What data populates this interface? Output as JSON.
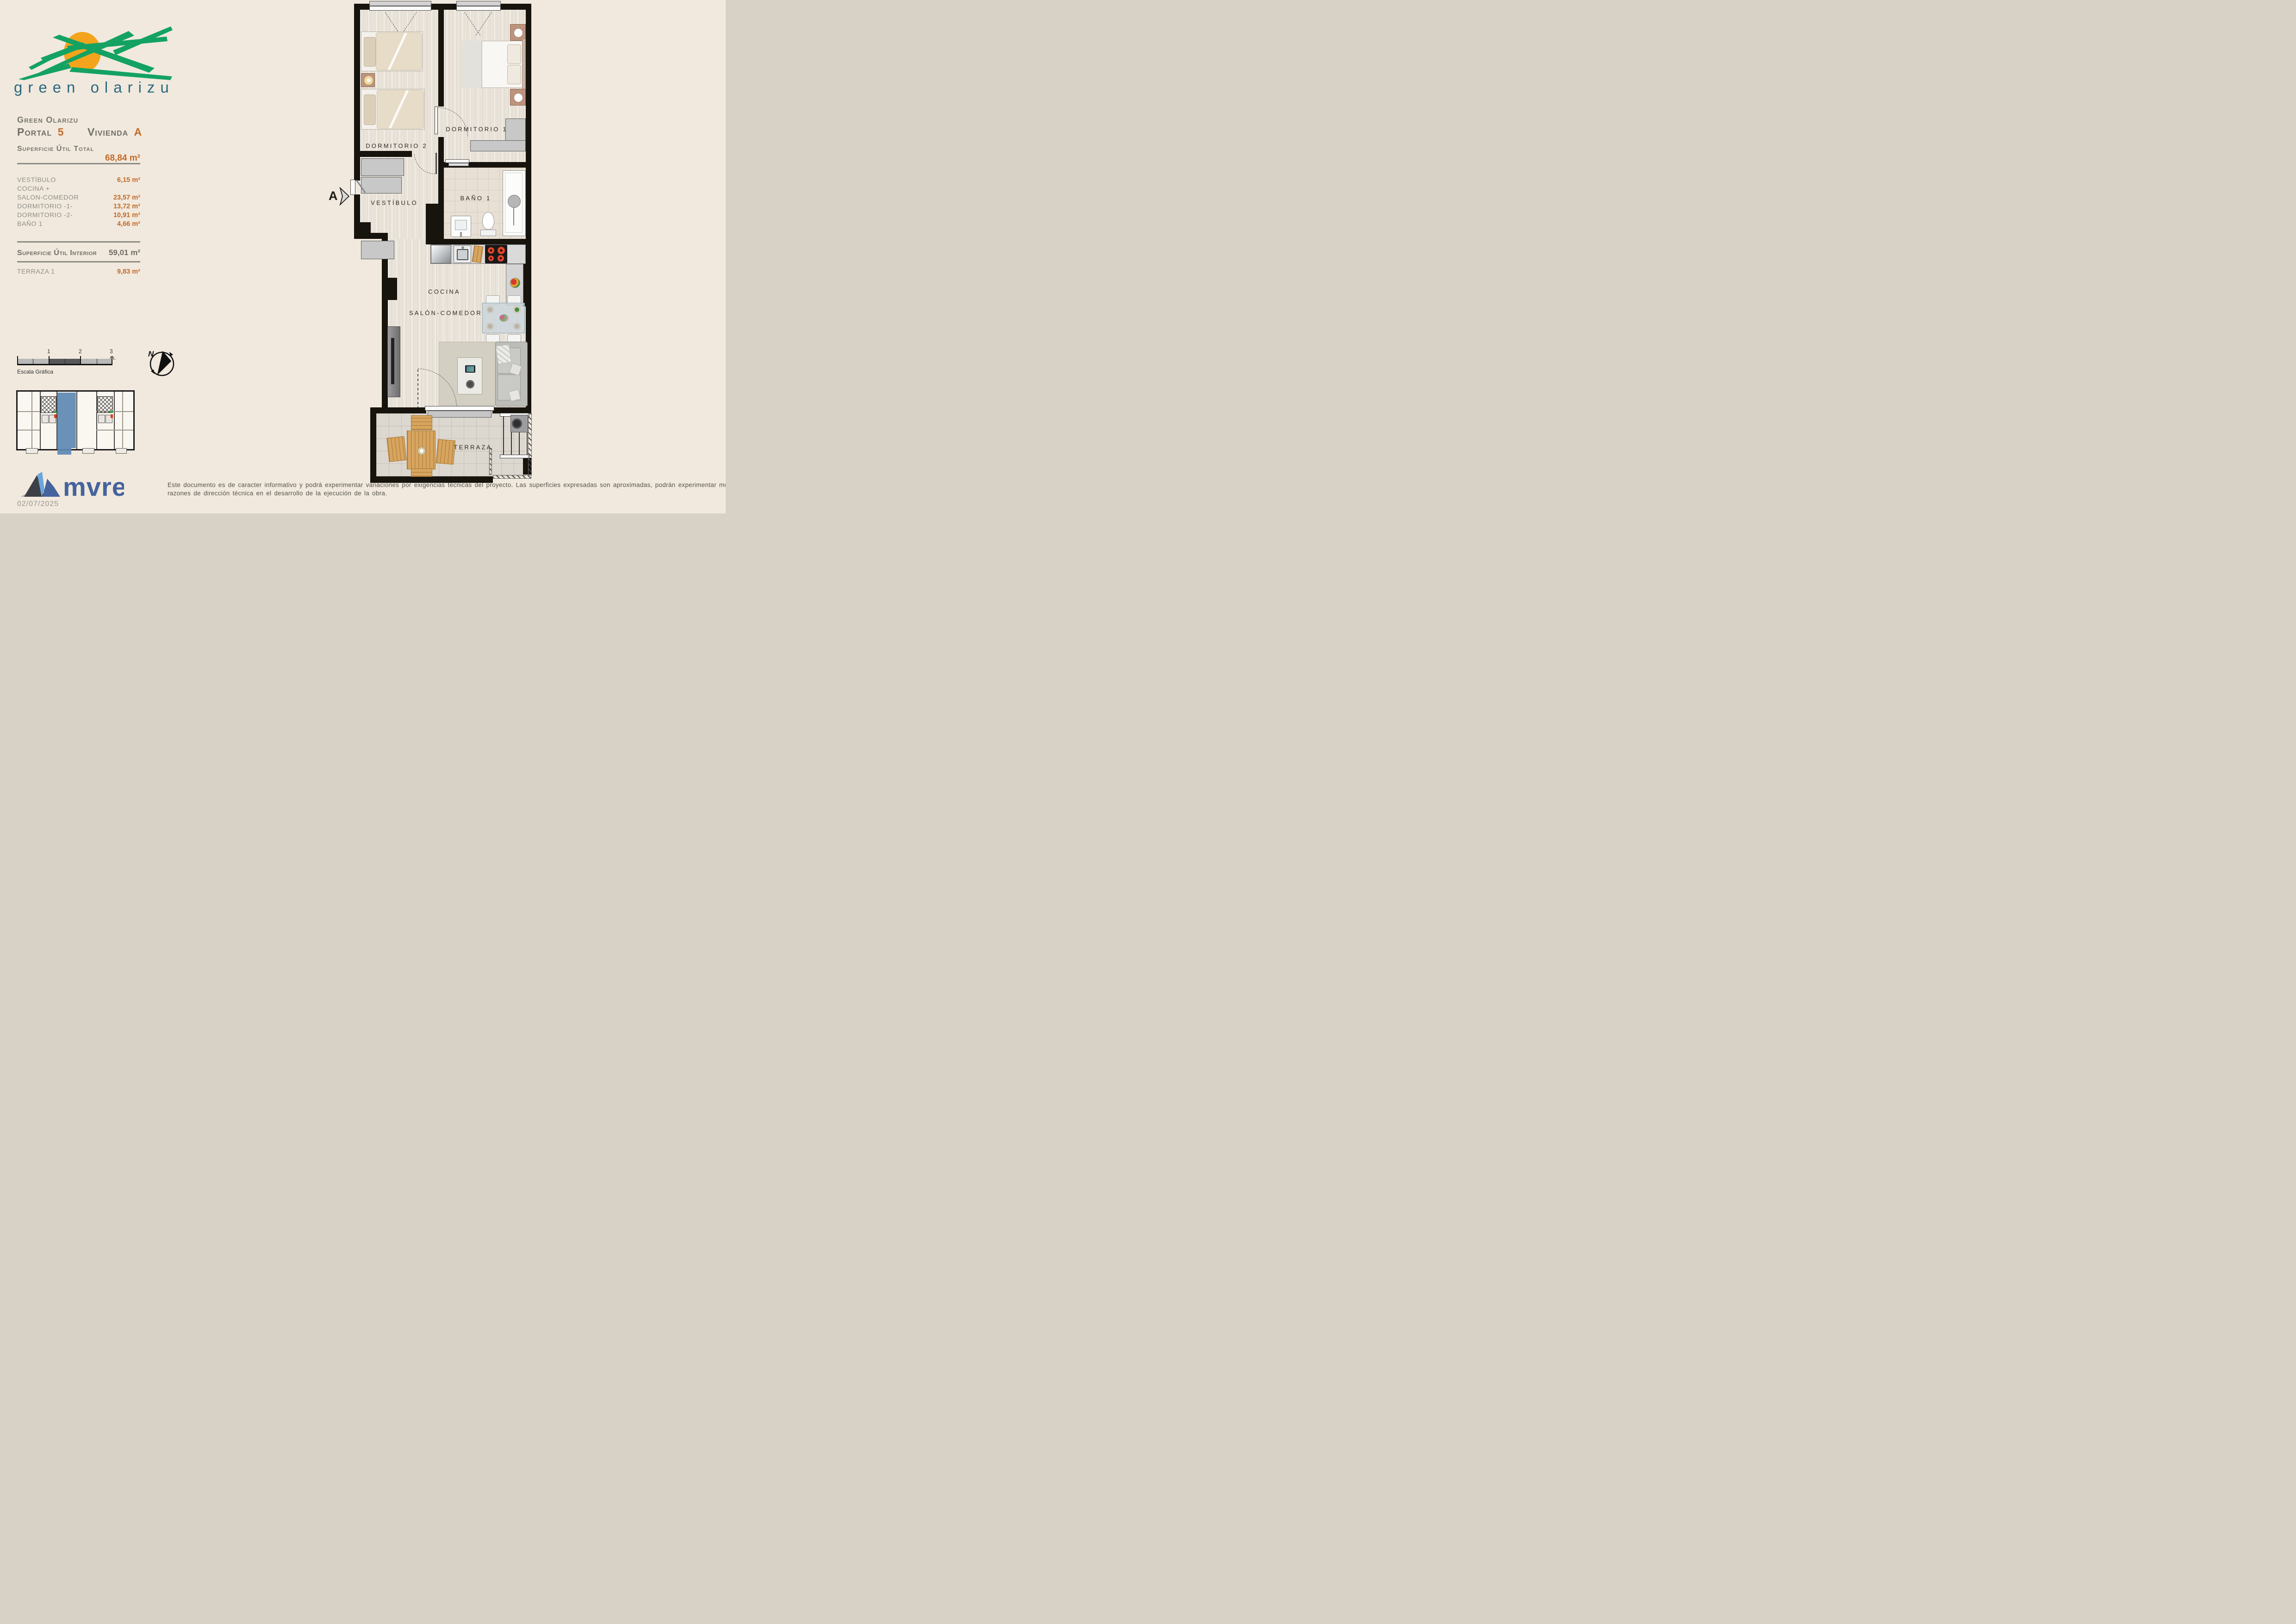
{
  "colors": {
    "background": "#f1e9dd",
    "accent_orange": "#c26a2b",
    "text_gray": "#77756f",
    "logo_green": "#14a263",
    "logo_text_teal": "#2a6880",
    "mvre_blue": "#45639d",
    "keyplan_highlight_blue": "#5d89b4",
    "wall_black": "#17130d"
  },
  "logo": {
    "text": "green olarizu"
  },
  "header": {
    "project": "Green Olarizu",
    "portal_label": "Portal",
    "portal_value": "5",
    "unit_label": "Vivienda",
    "unit_value": "A"
  },
  "surfaces": {
    "total_label": "Superficie Útil Total",
    "total_value": "68,84 m²",
    "rows": [
      {
        "label": "VESTÍBULO",
        "value": "6,15 m²"
      },
      {
        "label": "COCINA +",
        "value": ""
      },
      {
        "label": "SALON-COMEDOR",
        "value": "23,57 m²"
      },
      {
        "label": "DORMITORIO -1-",
        "value": "13,72 m²"
      },
      {
        "label": "DORMITORIO -2-",
        "value": "10,91 m²"
      },
      {
        "label": "BAÑO 1",
        "value": "4,66 m²"
      }
    ],
    "interior_label": "Superficie Útil Interior",
    "interior_value": "59,01 m²",
    "terrace_label": "TERRAZA 1",
    "terrace_value": "9,83 m²"
  },
  "scalebar": {
    "tick1": "1",
    "tick2": "2",
    "tick3": "3 m.",
    "caption": "Escala Gráfica"
  },
  "compass": {
    "north": "N"
  },
  "plan": {
    "marker": "A",
    "labels": {
      "dorm2": "DORMITORIO 2",
      "dorm1": "DORMITORIO 1",
      "vestibulo": "VESTÍBULO",
      "bano": "BAÑO 1",
      "cocina": "COCINA",
      "salon": "SALÓN-COMEDOR",
      "terraza": "TERRAZA"
    }
  },
  "footer": {
    "brand": "mvre",
    "date": "02/07/2025",
    "disclaimer_line1": "Este documento es de caracter informativo y podrá experimentar variaciones por exigencias técnicas del proyecto. Las superficies expresadas son aproximadas, podrán experimentar modificaciones por",
    "disclaimer_line2": "razones de dirección técnica en el desarrollo de la ejecución de la obra."
  }
}
